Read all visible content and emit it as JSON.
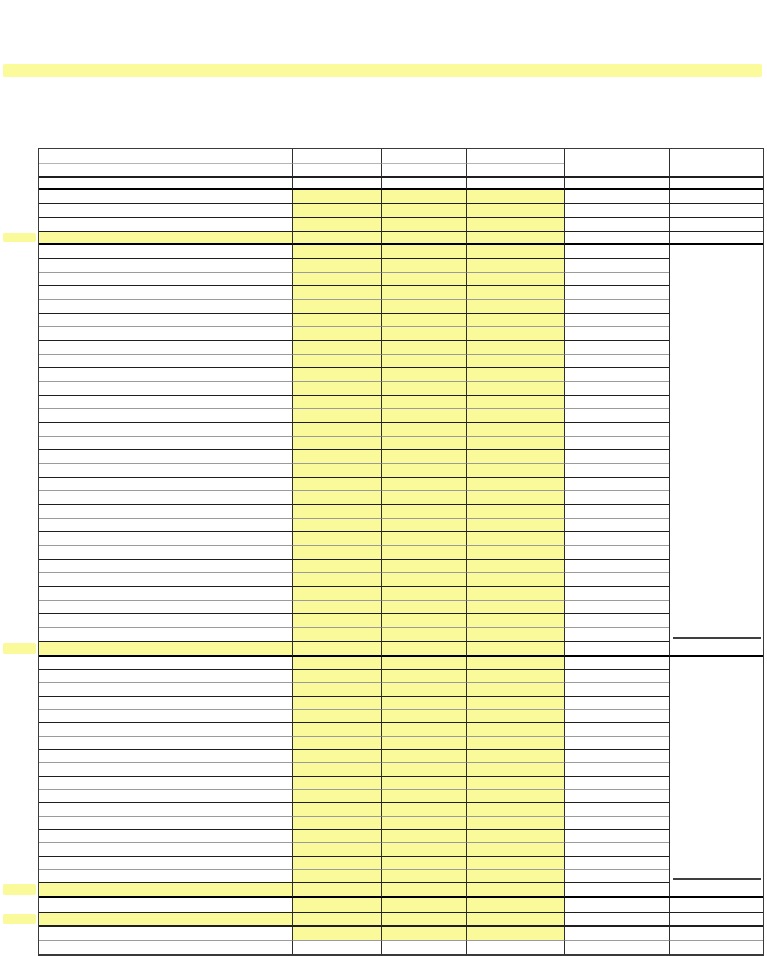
{
  "document": {
    "kind": "blank-ledger-form",
    "visible_text": "",
    "page_background": "#ffffff"
  },
  "colors": {
    "highlight": "#FAFA9B",
    "highlight_bar": "#FBFB9C",
    "grid_black": "#000000",
    "grid_dark": "#1f1f1f",
    "grid_gray": "#9b9b9b",
    "grid_light": "#b4b4b4",
    "grid_vertical": "#2e2e2e",
    "outer_border": "#3a3a3a",
    "underline": "#3f3f3f"
  },
  "highlight_bar": {
    "present": true
  },
  "sheet": {
    "columns": [
      {
        "name": "label-column",
        "width": 253
      },
      {
        "name": "input-column-1",
        "width": 89
      },
      {
        "name": "input-column-2",
        "width": 85
      },
      {
        "name": "input-column-3",
        "width": 98
      },
      {
        "name": "value-column",
        "width": 105
      },
      {
        "name": "total-column",
        "width": 94
      }
    ],
    "rows": [
      {
        "h": 15,
        "kind": "header",
        "line": "header-thin",
        "span": "AD"
      },
      {
        "h": 14,
        "kind": "header",
        "line": "dark2",
        "span": "full"
      },
      {
        "h": 12,
        "kind": "header",
        "line": "black2",
        "span": "full"
      },
      {
        "h": 14,
        "kind": "entry",
        "fill": "BCD",
        "line": "dark1",
        "span": "full"
      },
      {
        "h": 14,
        "kind": "entry",
        "fill": "BCD",
        "line": "dark1",
        "span": "full"
      },
      {
        "h": 14,
        "kind": "entry",
        "fill": "BCD",
        "line": "dark1",
        "span": "full"
      },
      {
        "h": 13,
        "kind": "subtotal",
        "fill": "ABCD",
        "line": "black2",
        "span": "full",
        "marker": true
      },
      {
        "repeat": 29,
        "kind": "entry",
        "fill": "BCD",
        "span": "AE",
        "h_pattern": [
          14,
          14,
          13
        ],
        "line_pattern": [
          "dark1",
          "gray"
        ],
        "f_underline_last": true
      },
      {
        "h": 15,
        "kind": "subtotal",
        "fill": "ABCD",
        "line": "black2",
        "span": "full",
        "marker": true
      },
      {
        "repeat": 17,
        "kind": "entry",
        "fill": "BCD",
        "span": "AE",
        "h_pattern": [
          13,
          13,
          14
        ],
        "line_pattern": [
          "dark1",
          "gray"
        ],
        "f_underline_last": true
      },
      {
        "h": 15,
        "kind": "subtotal",
        "fill": "ABCD",
        "line": "black2",
        "span": "full",
        "marker": true
      },
      {
        "h": 15,
        "kind": "entry",
        "fill": "BCD",
        "line": "dark1",
        "span": "full"
      },
      {
        "h": 14,
        "kind": "subtotal",
        "fill": "ABCD",
        "line": "dark2",
        "span": "full",
        "marker": true
      },
      {
        "h": 14,
        "kind": "entry",
        "fill": "BCD",
        "line": "gray",
        "span": "full"
      },
      {
        "h": 13,
        "kind": "blank",
        "span": "none"
      }
    ]
  }
}
